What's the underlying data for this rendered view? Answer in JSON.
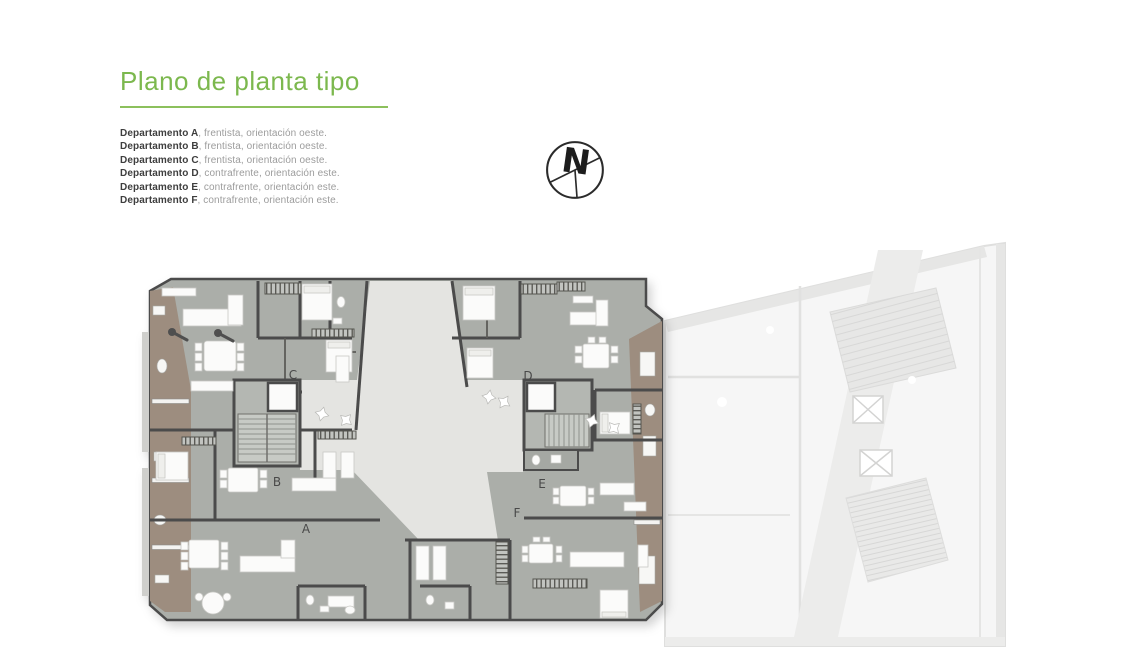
{
  "title": {
    "text": "Plano de planta tipo",
    "color": "#7cb84e"
  },
  "legend": {
    "items": [
      {
        "name": "Departamento A",
        "desc": ", frentista, orientación oeste."
      },
      {
        "name": "Departamento B",
        "desc": ", frentista, orientación oeste."
      },
      {
        "name": "Departamento C",
        "desc": ", frentista, orientación oeste."
      },
      {
        "name": "Departamento D",
        "desc": ", contrafrente, orientación este."
      },
      {
        "name": "Departamento E",
        "desc": ", contrafrente, orientación este."
      },
      {
        "name": "Departamento F",
        "desc": ", contrafrente, orientación este."
      }
    ]
  },
  "compass": {
    "label": "N"
  },
  "floor_plan": {
    "unit_labels": [
      {
        "id": "A",
        "x": 306,
        "y": 533
      },
      {
        "id": "B",
        "x": 277,
        "y": 486
      },
      {
        "id": "C",
        "x": 293,
        "y": 379
      },
      {
        "id": "D",
        "x": 528,
        "y": 380
      },
      {
        "id": "E",
        "x": 542,
        "y": 488
      },
      {
        "id": "F",
        "x": 517,
        "y": 517
      }
    ],
    "colors": {
      "wall": "#4b4b4b",
      "floor": "#abaea9",
      "balcony": "#9d8d7f",
      "courtyard": "#e4e4e1",
      "ghost_building": "#ededec",
      "accent_green": "#7cb84e"
    }
  }
}
